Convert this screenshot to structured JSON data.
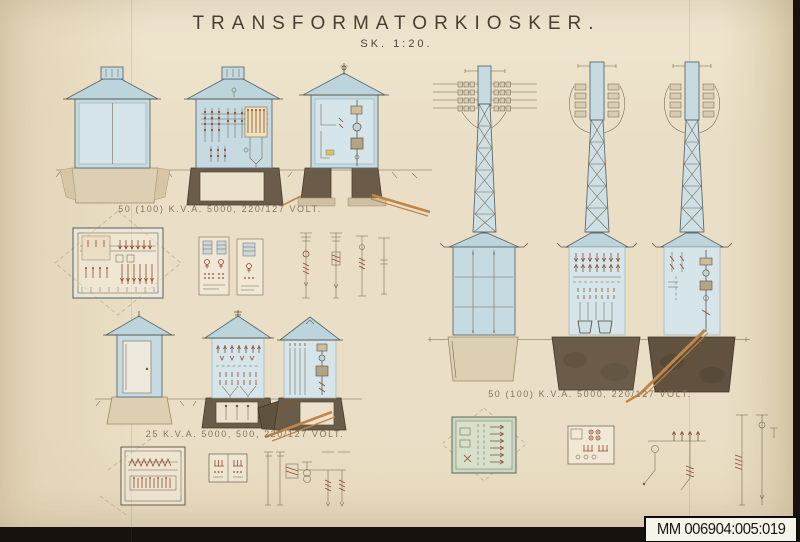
{
  "document": {
    "title": "TRANSFORMATORKIOSKER.",
    "scale_note": "SK. 1:20.",
    "captions": {
      "row1": "50 (100) K.V.A. 5000, 220/127 VOLT.",
      "row2": "25 K.V.A. 5000, 500, 220/127 VOLT.",
      "towers": "50 (100) K.V.A. 5000, 220/127 VOLT."
    },
    "archive_label": "MM 006904:005:019"
  },
  "colors": {
    "photo_background": "#17120d",
    "paper": "#eadfc6",
    "ink": "#5b5040",
    "kiosk_blue": "#c6dbe1",
    "roof_blue": "#bcd4dc",
    "foundation_light": "#ddd0b2",
    "foundation_dark": "#6a5c48",
    "schematic_red": "#8a4a32",
    "cable_orange": "#c08548",
    "plan_green": "#ccd6c2",
    "label_background": "#f6f3ea"
  }
}
